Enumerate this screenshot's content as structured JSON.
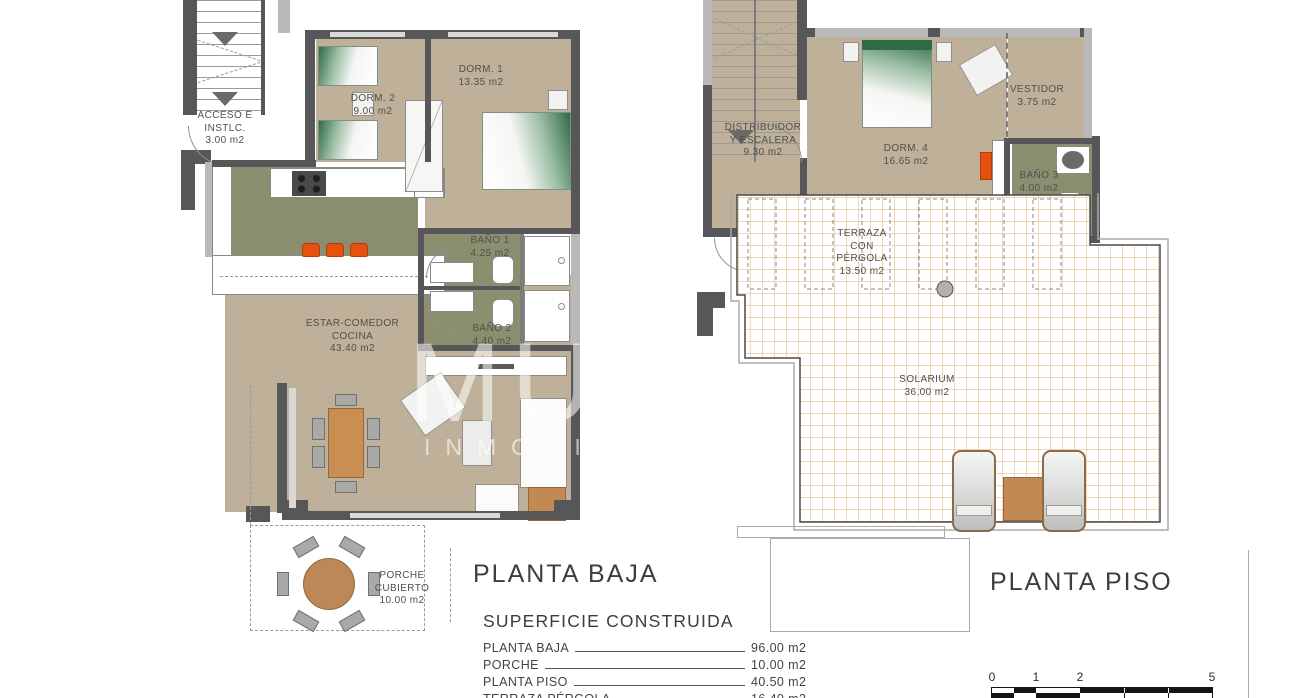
{
  "watermark": {
    "big": "MUN",
    "small": "INMOBILIA"
  },
  "floor_plans": {
    "planta_baja": {
      "title": "PLANTA BAJA",
      "rooms": {
        "acceso": {
          "name": "ACCESO E INSTLC.",
          "area": "3.00 m2"
        },
        "dorm2": {
          "name": "DORM. 2",
          "area": "9.00 m2"
        },
        "dorm1": {
          "name": "DORM. 1",
          "area": "13.35 m2"
        },
        "bano1": {
          "name": "BAÑO 1",
          "area": "4.25 m2"
        },
        "bano2": {
          "name": "BAÑO 2",
          "area": "4.40 m2"
        },
        "estar": {
          "name": "ESTAR-COMEDOR COCINA",
          "area": "43.40 m2"
        },
        "porche": {
          "name": "PORCHE CUBIERTO",
          "area": "10.00 m2"
        }
      }
    },
    "planta_piso": {
      "title": "PLANTA PISO",
      "rooms": {
        "distribuidor": {
          "name": "DISTRIBUIDOR Y ESCALERA",
          "area": "9.30 m2"
        },
        "dorm4": {
          "name": "DORM. 4",
          "area": "16.65 m2"
        },
        "vestidor": {
          "name": "VESTIDOR",
          "area": "3.75 m2"
        },
        "bano3": {
          "name": "BAÑO 3",
          "area": "4.00 m2"
        },
        "terraza": {
          "name": "TERRAZA CON PÉRGOLA",
          "area": "13.50 m2"
        },
        "solarium": {
          "name": "SOLARIUM",
          "area": "36.00 m2"
        }
      }
    }
  },
  "summary": {
    "title": "SUPERFICIE CONSTRUIDA",
    "rows": [
      {
        "label": "PLANTA BAJA",
        "value": "96.00 m2"
      },
      {
        "label": "PORCHE",
        "value": "10.00 m2"
      },
      {
        "label": "PLANTA PISO",
        "value": "40.50 m2"
      },
      {
        "label": "TERRAZA PÉRGOLA",
        "value": "16.40 m2"
      }
    ]
  },
  "scale_bar": {
    "labels": [
      "0",
      "1",
      "2",
      "5"
    ]
  },
  "colors": {
    "floor_tan": "#bfb199",
    "floor_olive": "#8c8e70",
    "wall_dark": "#57575a",
    "wall_light": "#b9b9bb",
    "accent_orange": "#e5520e",
    "furniture_brown": "#c28a52",
    "solarium_grid": "#e09a50",
    "bed_green": "#2f6b47"
  }
}
